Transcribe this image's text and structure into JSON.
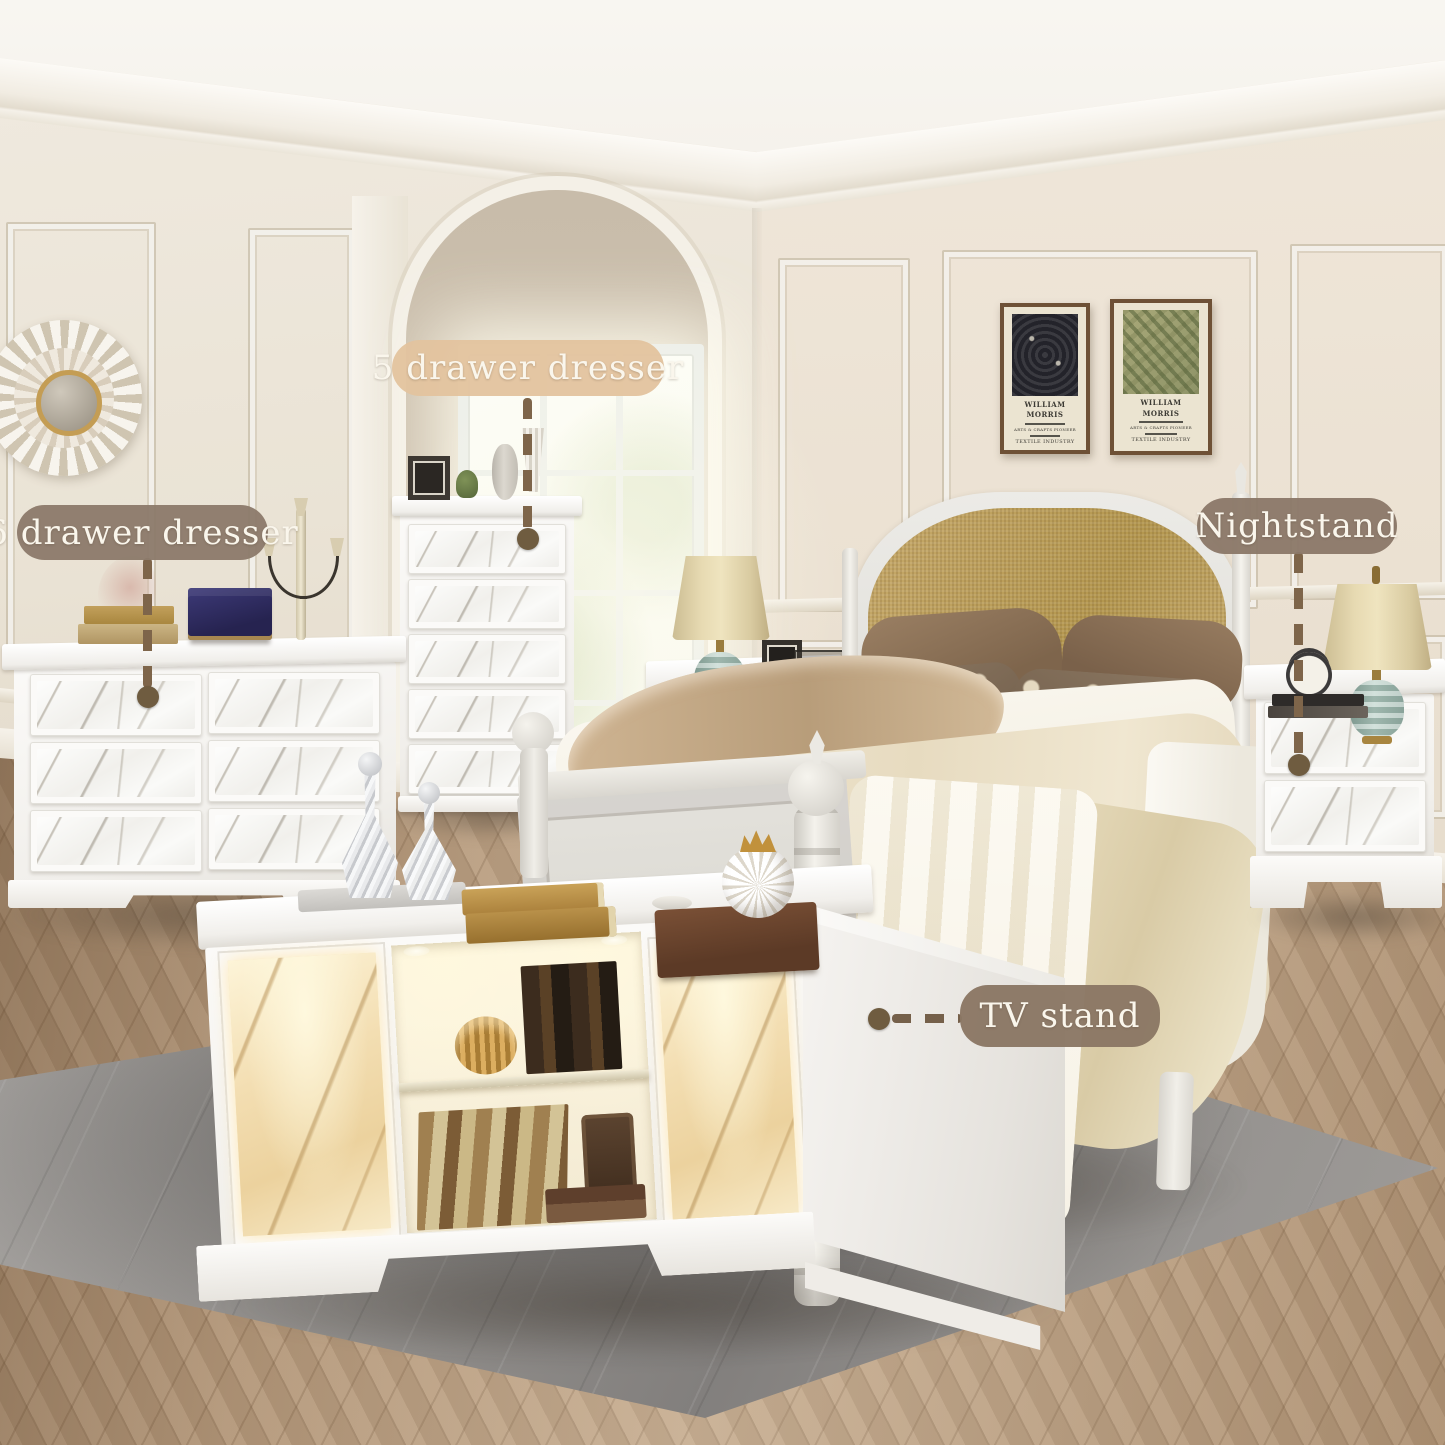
{
  "scene": {
    "description": "Bedroom furniture set product photo: classic cream room, herringbone wood floor, gray rug, white marble-front furniture with callout labels"
  },
  "labels": {
    "five_drawer": {
      "text": "5 drawer dresser"
    },
    "six_drawer": {
      "text": "6 drawer dresser"
    },
    "nightstand": {
      "text": "Nightstand"
    },
    "tv_stand": {
      "text": "TV stand"
    }
  },
  "posters": {
    "left": {
      "title": "WILLIAM MORRIS",
      "subtitle": "ARTS & CRAFTS PIONEER",
      "footer": "TEXTILE INDUSTRY"
    },
    "right": {
      "title": "WILLIAM MORRIS",
      "subtitle": "ARTS & CRAFTS PIONEER",
      "footer": "TEXTILE INDUSTRY"
    }
  },
  "colors": {
    "label_tan": "#e3c19e",
    "label_taupe": "#8d7b6b",
    "label_dark_taupe": "#8a7764",
    "connector_brown": "#7a6348",
    "wall_cream": "#ece4d6",
    "floor_wood": "#bb9e7f",
    "rug_gray": "#8f8c8a",
    "headboard_fabric": "#bfa263",
    "marble_white": "#f7f7f4",
    "marble_gold_glow": "#f3deb2",
    "lamp_celadon": "#9db5ac",
    "lamp_shade_beige": "#e0d3a8"
  }
}
